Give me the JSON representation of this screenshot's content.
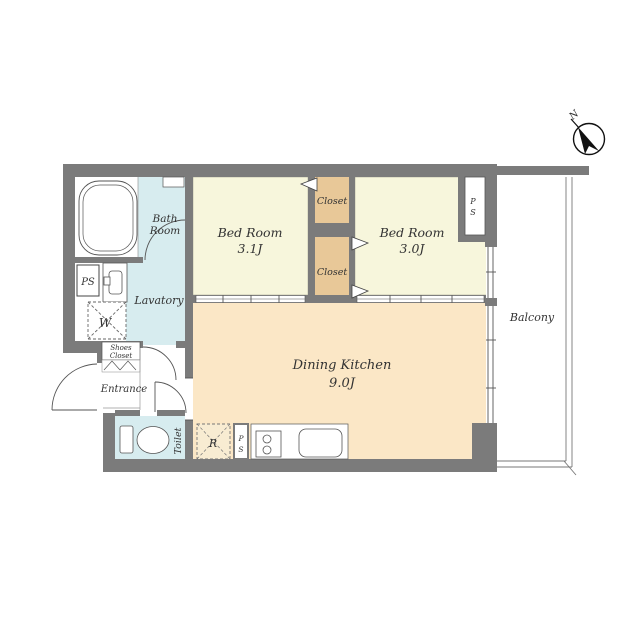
{
  "plan_title": "2DK apartment floor plan",
  "palette": {
    "wall_gray": "#7b7b7b",
    "bedroom_fill": "#f7f6dc",
    "closet_fill": "#e8c898",
    "dining_kitchen_fill": "#fbe7c6",
    "wet_area_fill": "#d7ecef",
    "refrigerator_fill": "#f8ecd2",
    "line_color": "#555555",
    "text_color": "#333333"
  },
  "compass": {
    "label": "N"
  },
  "rooms": {
    "bath": {
      "line1": "Bath",
      "line2": "Room"
    },
    "lavatory": {
      "label": "Lavatory"
    },
    "bedroom1": {
      "name": "Bed Room",
      "size": "3.1J"
    },
    "bedroom2": {
      "name": "Bed Room",
      "size": "3.0J"
    },
    "closet_top": {
      "label": "Closet"
    },
    "closet_bottom": {
      "label": "Closet"
    },
    "dining_kitchen": {
      "name": "Dining Kitchen",
      "size": "9.0J"
    },
    "balcony": {
      "label": "Balcony"
    },
    "entrance": {
      "label": "Entrance"
    },
    "toilet": {
      "label": "Toilet"
    },
    "shoes_closet": {
      "line1": "Shoes",
      "line2": "Closet"
    }
  },
  "fixtures": {
    "ps_left": {
      "label": "PS"
    },
    "ps_right": {
      "letter1": "P",
      "letter2": "S"
    },
    "ps_kitchen": {
      "letter1": "P",
      "letter2": "S"
    },
    "washer": {
      "label": "W"
    },
    "refrigerator": {
      "label": "R"
    }
  }
}
